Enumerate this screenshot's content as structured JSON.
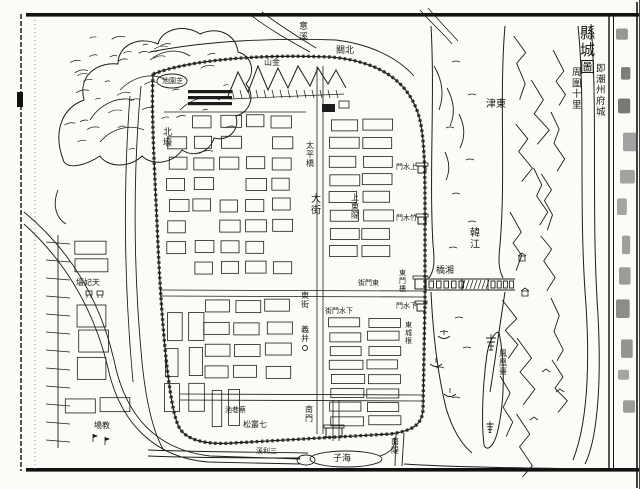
{
  "page": {
    "title_main": "縣城圖",
    "title_sub": [
      "即潮州府城",
      "周圍十里"
    ],
    "paper_color": "#fcfbf7",
    "ink_color": "#1c1c1c"
  },
  "map": {
    "labels": [
      {
        "text": "意溪",
        "x": 299,
        "y": 20,
        "dir": "v",
        "size": 9
      },
      {
        "text": "北關",
        "x": 336,
        "y": 44,
        "dir": "rtl",
        "size": 9
      },
      {
        "text": "東津",
        "x": 486,
        "y": 97,
        "dir": "rtl",
        "size": 10
      },
      {
        "text": "北壕",
        "x": 163,
        "y": 126,
        "dir": "v",
        "size": 9
      },
      {
        "text": "金山",
        "x": 264,
        "y": 57,
        "dir": "rtl",
        "size": 8
      },
      {
        "text": "芝園池",
        "x": 162,
        "y": 76,
        "dir": "rtl",
        "size": 7
      },
      {
        "text": "韓江",
        "x": 470,
        "y": 226,
        "dir": "v",
        "size": 10
      },
      {
        "text": "湘橋",
        "x": 436,
        "y": 264,
        "dir": "rtl",
        "size": 9
      },
      {
        "text": "鳳凰臺",
        "x": 499,
        "y": 348,
        "dir": "v",
        "size": 8
      },
      {
        "text": "上水門",
        "x": 396,
        "y": 162,
        "dir": "rtl",
        "size": 7
      },
      {
        "text": "竹木門",
        "x": 396,
        "y": 213,
        "dir": "rtl",
        "size": 7
      },
      {
        "text": "東門樓",
        "x": 399,
        "y": 268,
        "dir": "v",
        "size": 7
      },
      {
        "text": "下水門",
        "x": 396,
        "y": 301,
        "dir": "rtl",
        "size": 7
      },
      {
        "text": "東門街",
        "x": 358,
        "y": 278,
        "dir": "rtl",
        "size": 7
      },
      {
        "text": "下水門街",
        "x": 325,
        "y": 306,
        "dir": "rtl",
        "size": 7
      },
      {
        "text": "太平橋",
        "x": 306,
        "y": 140,
        "dir": "v",
        "size": 8
      },
      {
        "text": "大街",
        "x": 311,
        "y": 192,
        "dir": "v",
        "size": 10
      },
      {
        "text": "上東隄",
        "x": 351,
        "y": 192,
        "dir": "v",
        "size": 8
      },
      {
        "text": "東街",
        "x": 301,
        "y": 290,
        "dir": "v",
        "size": 8
      },
      {
        "text": "義井",
        "x": 301,
        "y": 324,
        "dir": "v",
        "size": 8
      },
      {
        "text": "東城根",
        "x": 405,
        "y": 320,
        "dir": "v",
        "size": 7
      },
      {
        "text": "南門",
        "x": 305,
        "y": 404,
        "dir": "v",
        "size": 8
      },
      {
        "text": "七叢松",
        "x": 243,
        "y": 419,
        "dir": "rtl",
        "size": 8
      },
      {
        "text": "蔡巷池",
        "x": 225,
        "y": 405,
        "dir": "rtl",
        "size": 7
      },
      {
        "text": "海子",
        "x": 333,
        "y": 452,
        "dir": "rtl",
        "size": 9
      },
      {
        "text": "南隄",
        "x": 391,
        "y": 436,
        "dir": "v",
        "size": 8
      },
      {
        "text": "三利溪",
        "x": 256,
        "y": 446,
        "dir": "rtl",
        "size": 7
      },
      {
        "text": "天妃壇",
        "x": 76,
        "y": 277,
        "dir": "rtl",
        "size": 8
      },
      {
        "text": "教場",
        "x": 94,
        "y": 420,
        "dir": "rtl",
        "size": 8
      }
    ]
  }
}
